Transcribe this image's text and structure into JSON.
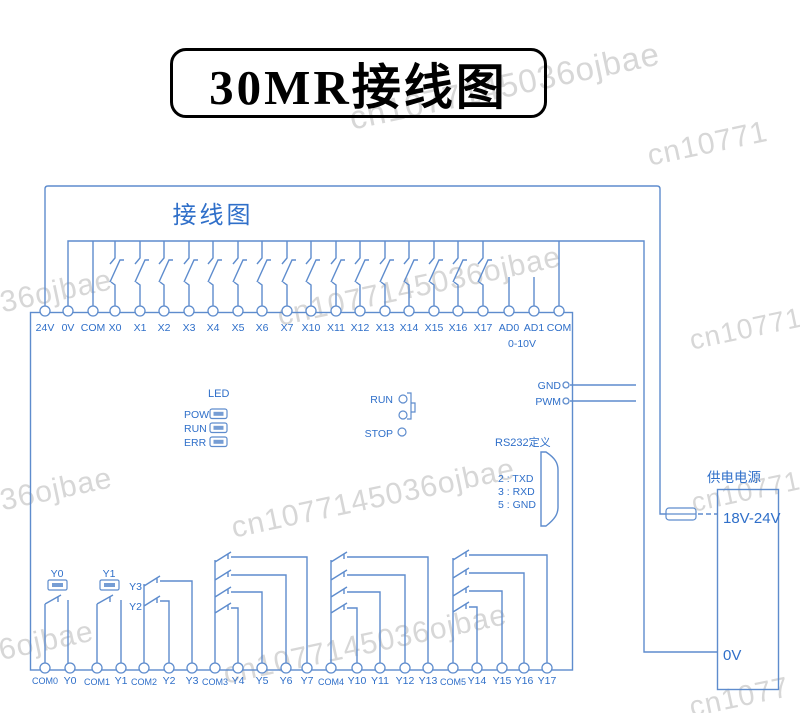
{
  "title_banner": {
    "text": "30MR接线图"
  },
  "diagram_label": "接线图",
  "top_terminals": [
    "24V",
    "0V",
    "COM",
    "X0",
    "X1",
    "X2",
    "X3",
    "X4",
    "X5",
    "X6",
    "X7",
    "X10",
    "X11",
    "X12",
    "X13",
    "X14",
    "X15",
    "X16",
    "X17",
    "AD0",
    "AD1",
    "COM"
  ],
  "analog_range_label": "0-10V",
  "led_panel": {
    "title": "LED",
    "rows": [
      "POW",
      "RUN",
      "ERR"
    ]
  },
  "mode_switch": {
    "run": "RUN",
    "stop": "STOP"
  },
  "aux_outputs": {
    "gnd": "GND",
    "pwm": "PWM"
  },
  "rs232": {
    "title": "RS232定义",
    "pins": [
      "2 : TXD",
      "3 : RXD",
      "5 : GND"
    ]
  },
  "power_supply": {
    "title": "供电电源",
    "positive": "18V-24V",
    "negative": "0V"
  },
  "relay_coil_labels": [
    "Y0",
    "Y1"
  ],
  "relay_contact_labels": [
    "Y3",
    "Y2"
  ],
  "bottom_terminals": [
    "COM0",
    "Y0",
    "COM1",
    "Y1",
    "COM2",
    "Y2",
    "Y3",
    "COM3",
    "Y4",
    "Y5",
    "Y6",
    "Y7",
    "COM4",
    "Y10",
    "Y11",
    "Y12",
    "Y13",
    "COM5",
    "Y14",
    "Y15",
    "Y16",
    "Y17"
  ],
  "watermarks": [
    "cn1077145036ojbae",
    "cn10771",
    "J36ojbae",
    "cn1077145036ojbae",
    "cn10771",
    "J36ojbae",
    "cn1077145036ojbae",
    "36ojbae",
    "cn1077145036ojbae",
    "cn1077",
    "cn10771"
  ],
  "colors": {
    "line": "#5e8ccd",
    "text-blue": "#2f6fc9",
    "title": "#000000",
    "watermark": "#d7d7d7"
  }
}
